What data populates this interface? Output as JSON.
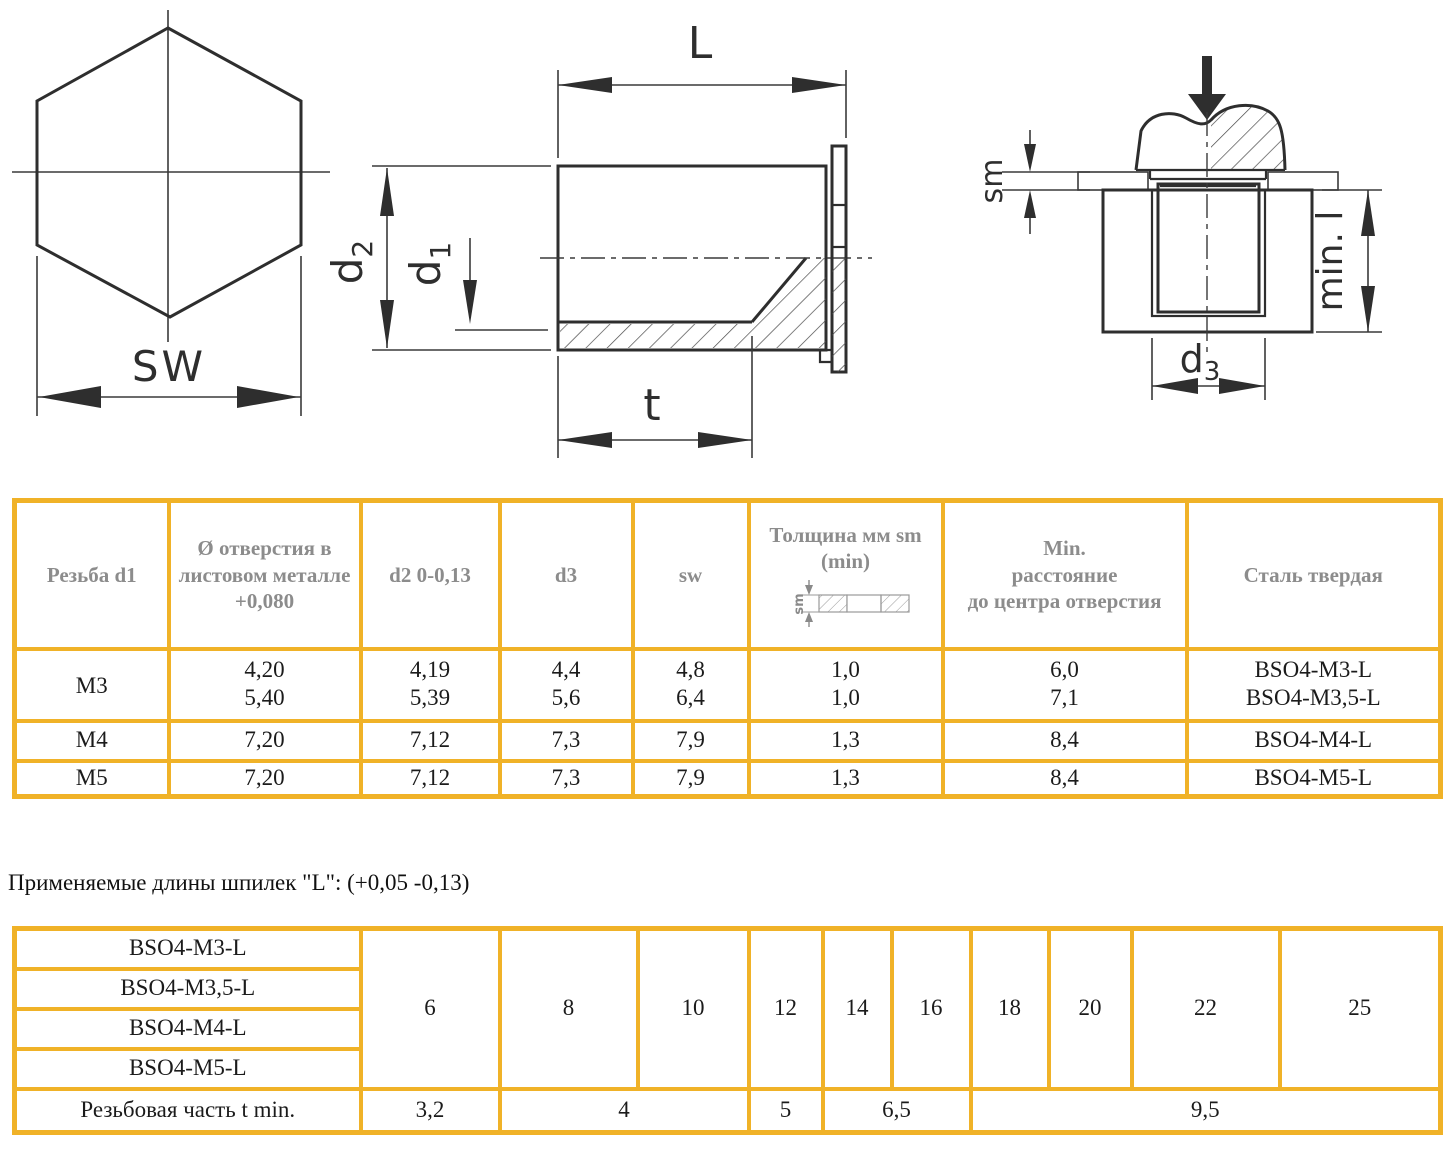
{
  "drawings": {
    "hex_view": {
      "sw_label": "SW"
    },
    "side_view": {
      "l_label": "L",
      "d2_base": "d",
      "d2_sub": "2",
      "d1_base": "d",
      "d1_sub": "1",
      "t_label": "t"
    },
    "installed_view": {
      "sm_label": "sm",
      "min_l_label": "min. l",
      "d3_base": "d",
      "d3_sub": "3"
    }
  },
  "table1": {
    "header": {
      "thread": "Резьба d1",
      "hole_lines": [
        "Ø отверстия в",
        "листовом металле",
        "+0,080"
      ],
      "d2": "d2 0-0,13",
      "d3": "d3",
      "sw": "sw",
      "sm_lines": [
        "Толщина мм sm",
        "(min)"
      ],
      "sm_diagram_label": "sm",
      "min_dist_lines": [
        "Min.",
        "расстояние",
        "до центра отверстия"
      ],
      "steel": "Сталь твердая"
    },
    "rows": [
      {
        "thread": "M3",
        "hole": [
          "4,20",
          "5,40"
        ],
        "d2": [
          "4,19",
          "5,39"
        ],
        "d3": [
          "4,4",
          "5,6"
        ],
        "sw": [
          "4,8",
          "6,4"
        ],
        "sm": [
          "1,0",
          "1,0"
        ],
        "min_dist": [
          "6,0",
          "7,1"
        ],
        "steel": [
          "BSO4-M3-L",
          "BSO4-M3,5-L"
        ]
      },
      {
        "thread": "M4",
        "hole": "7,20",
        "d2": "7,12",
        "d3": "7,3",
        "sw": "7,9",
        "sm": "1,3",
        "min_dist": "8,4",
        "steel": "BSO4-M4-L"
      },
      {
        "thread": "M5",
        "hole": "7,20",
        "d2": "7,12",
        "d3": "7,3",
        "sw": "7,9",
        "sm": "1,3",
        "min_dist": "8,4",
        "steel": "BSO4-M5-L"
      }
    ]
  },
  "note": "Применяемые длины шпилек \"L\": (+0,05 -0,13)",
  "table2": {
    "row_labels": [
      "BSO4-M3-L",
      "BSO4-M3,5-L",
      "BSO4-M4-L",
      "BSO4-M5-L"
    ],
    "lengths": [
      "6",
      "8",
      "10",
      "12",
      "14",
      "16",
      "18",
      "20",
      "22",
      "25"
    ],
    "bottom_label": "Резьбовая часть t min.",
    "bottom_values": [
      "3,2",
      "4",
      "5",
      "6,5",
      "9,5"
    ]
  },
  "colors": {
    "table_border": "#F0B228",
    "header_text": "#8C8C8C",
    "data_text": "#1B1B1B",
    "drawing_line": "#2E2E2E"
  }
}
